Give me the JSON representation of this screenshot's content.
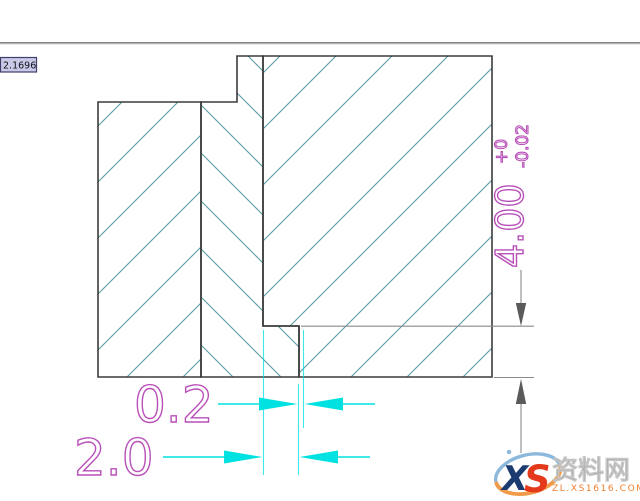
{
  "tooltip": {
    "value": "2.1696"
  },
  "dims": {
    "depth": {
      "value": "4.00",
      "tol_upper": "+0",
      "tol_lower": "-0.02"
    },
    "step": {
      "value": "0.2"
    },
    "width": {
      "value": "2.0"
    }
  },
  "watermark": {
    "logo_x": "X",
    "logo_s": "S",
    "site_name": "资料网",
    "site_url": "ZL.XS1616.COM"
  },
  "colors": {
    "hatch": "#5b98a1",
    "outline": "#3b3b3b",
    "dim_cyan": "#00e1e1",
    "dim_text": "#b950b9",
    "dim_gray": "#8a8a8a",
    "dim_gray_dark": "#5a5a5a",
    "tooltip_bg": "#cacae8",
    "tooltip_border": "#3e3e6a",
    "divider": "#858585",
    "wm_blue": "#1a3a70",
    "wm_red": "#e5391c",
    "wm_gray": "#a0a0a0",
    "wm_orange": "#ef7f2e",
    "wm_swoosh_blue": "#8cb8dc",
    "wm_swoosh_orange": "#f09a4a"
  }
}
